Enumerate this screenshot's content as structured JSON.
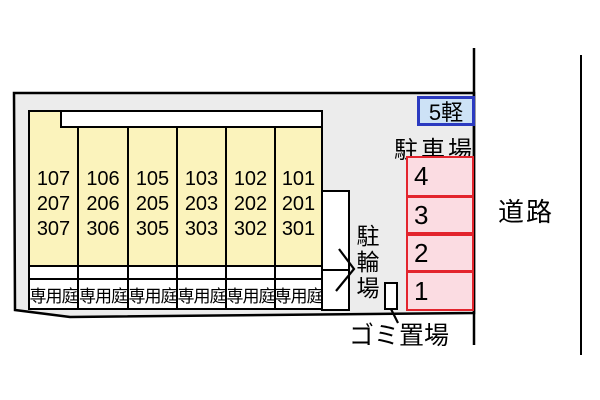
{
  "building": {
    "garden_label": "専用庭",
    "columns": [
      {
        "rooms": [
          "107",
          "207",
          "307"
        ]
      },
      {
        "rooms": [
          "106",
          "206",
          "306"
        ]
      },
      {
        "rooms": [
          "105",
          "205",
          "305"
        ]
      },
      {
        "rooms": [
          "103",
          "203",
          "303"
        ]
      },
      {
        "rooms": [
          "102",
          "202",
          "302"
        ]
      },
      {
        "rooms": [
          "101",
          "201",
          "301"
        ]
      }
    ]
  },
  "parking": {
    "area_label": "駐車場",
    "kei_space_label": "5軽",
    "spaces": [
      "4",
      "3",
      "2",
      "1"
    ]
  },
  "bicycle_area_label": "駐輪場",
  "garbage_area_label": "ゴミ置場",
  "road_label": "道路",
  "colors": {
    "plot_fill": "#ececec",
    "unit_fill": "#fbf3bc",
    "parking_space_fill": "#fbdce2",
    "parking_space_border": "#e3242d",
    "kei_space_fill": "#cde2f6",
    "kei_space_border": "#2b3ac0",
    "line": "#000000"
  }
}
